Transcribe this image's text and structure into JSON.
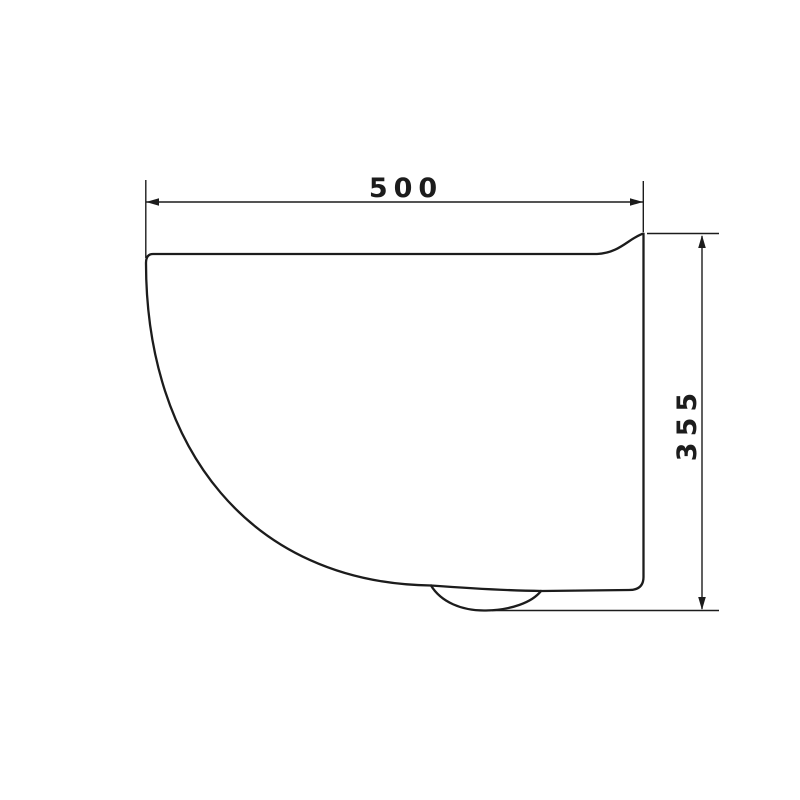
{
  "colors": {
    "line-color": "#1c1c1c",
    "background-color": "#ffffff",
    "text-color": "#1c1c1c"
  },
  "drawing": {
    "type": "technical-dimension-drawing",
    "subject": "wall-hung toilet side profile",
    "dimensions": {
      "width": {
        "label": "500",
        "value": 500
      },
      "height": {
        "label": "355",
        "value": 355
      }
    }
  }
}
